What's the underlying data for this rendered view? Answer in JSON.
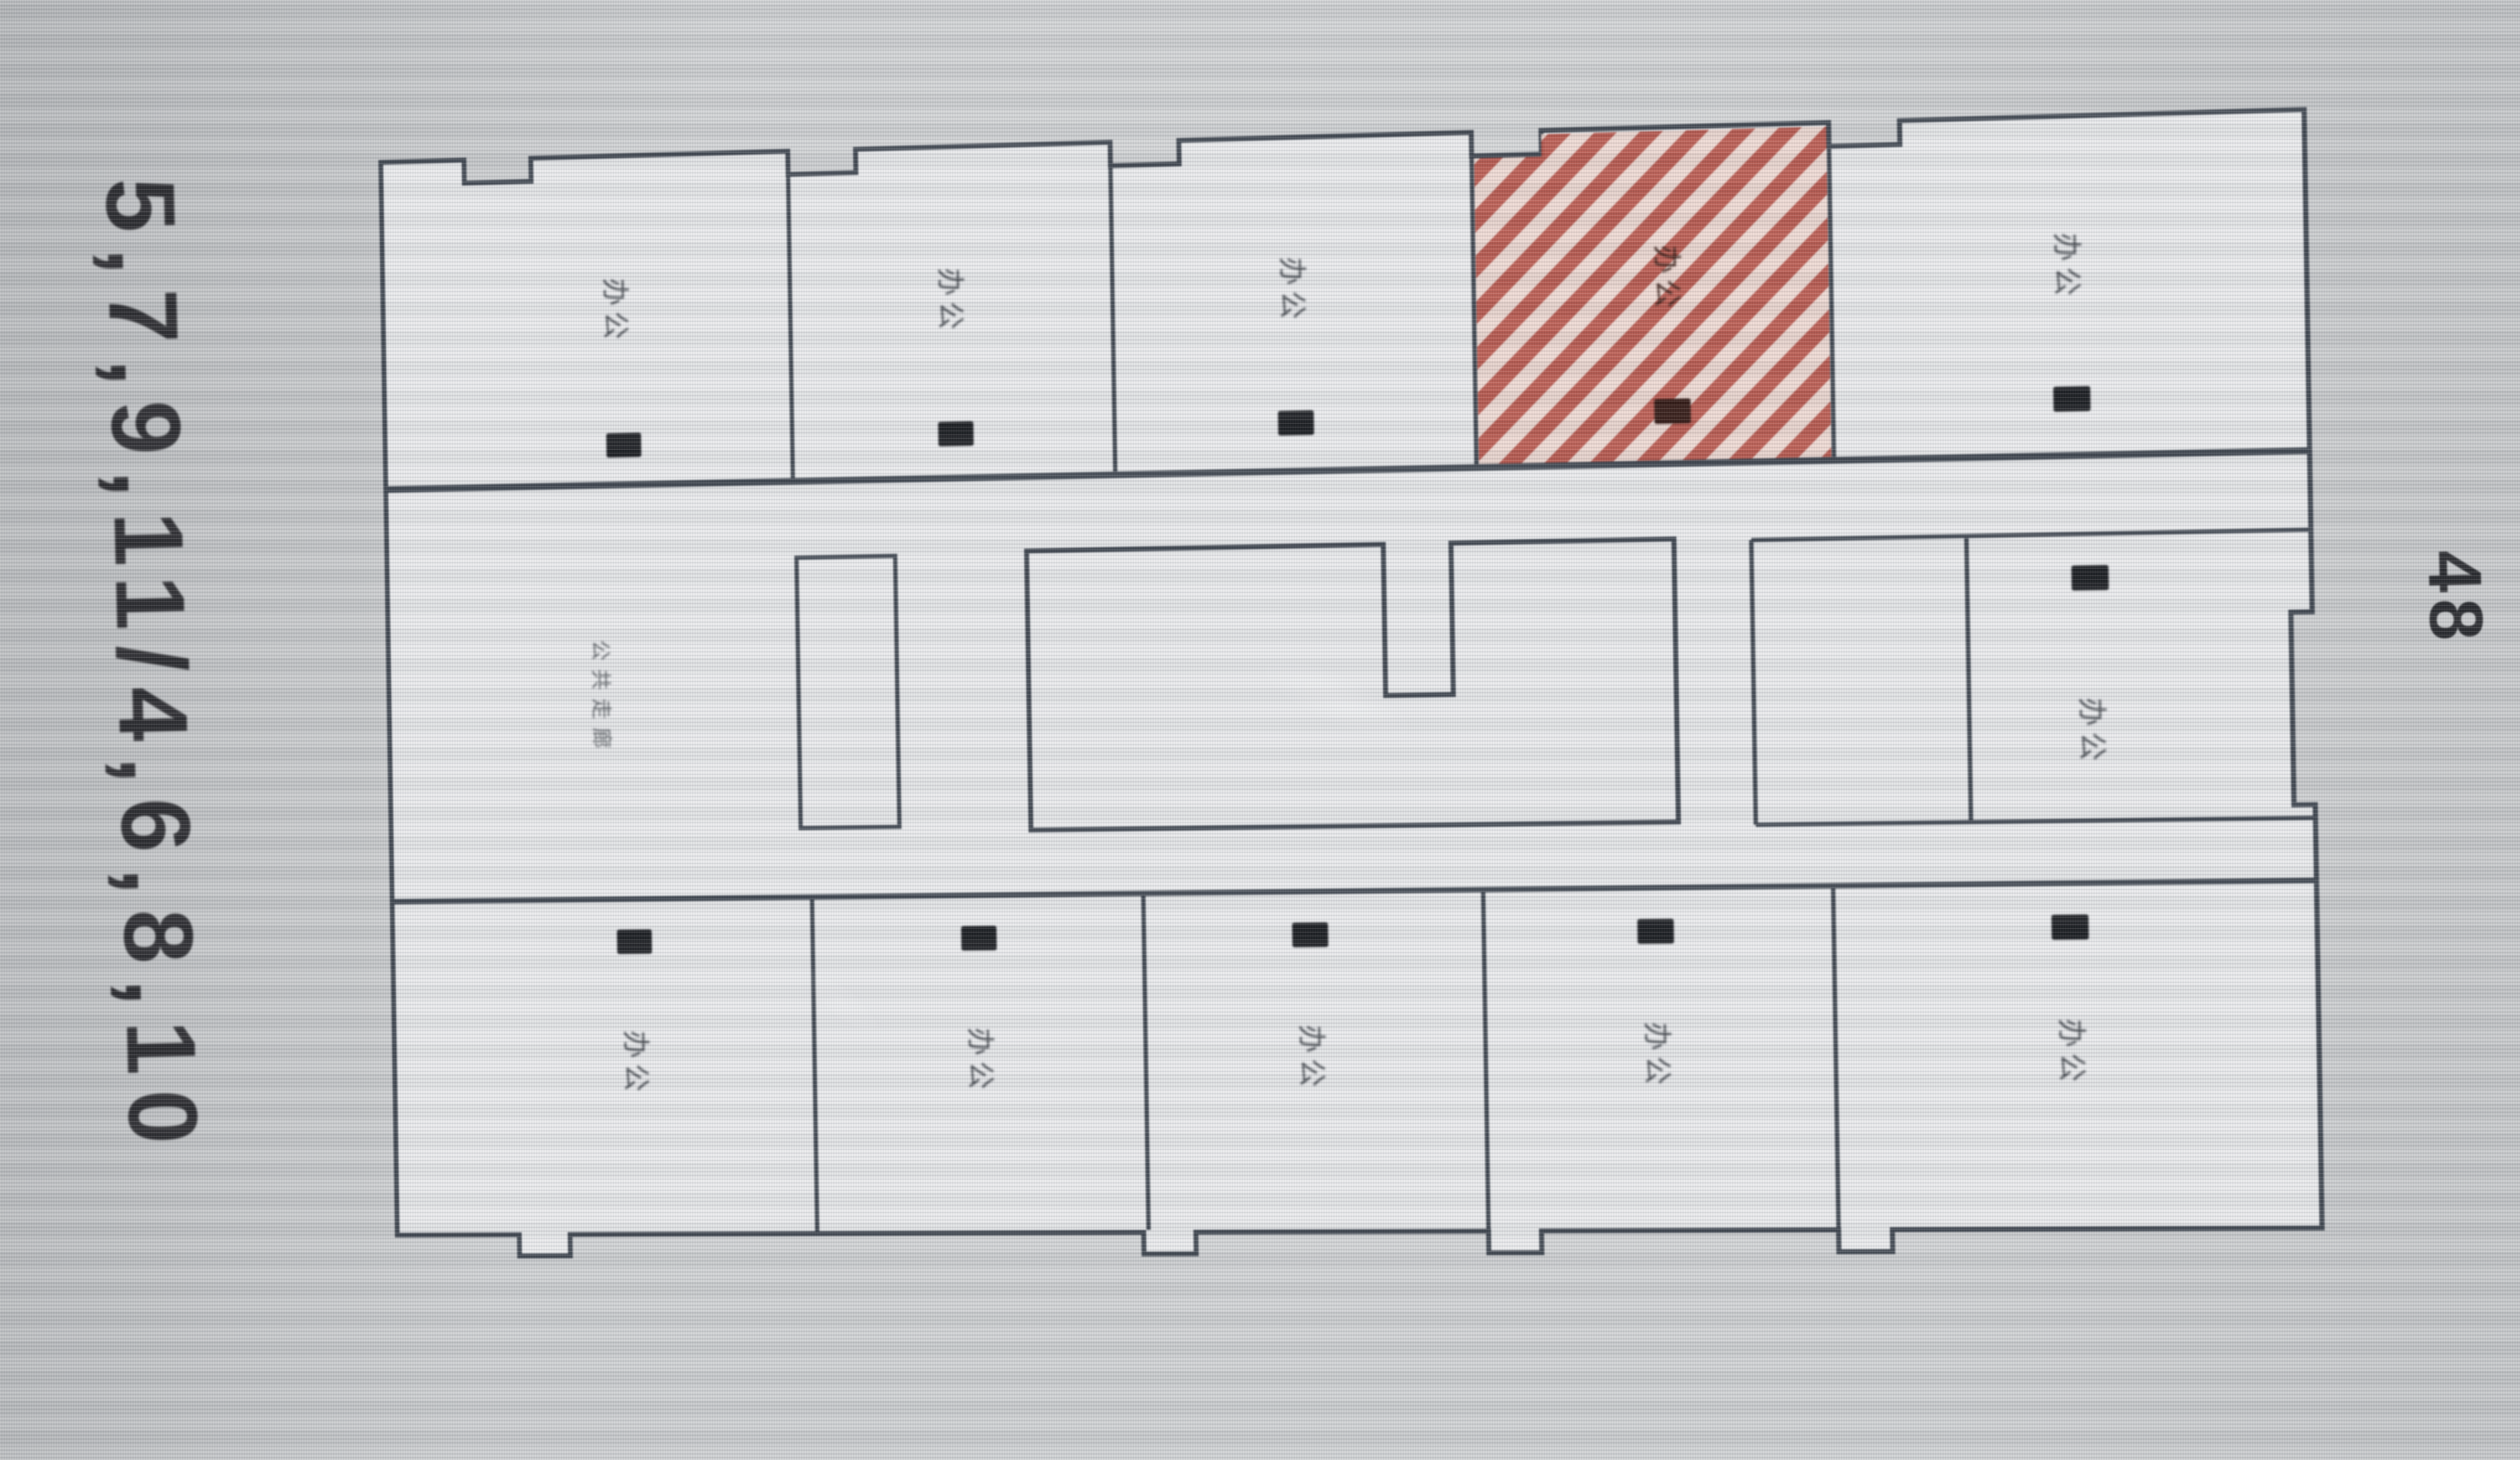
{
  "annotations": {
    "unit_list": "5,7,9,11/4,6,8,10",
    "floor_number": "48"
  },
  "plan": {
    "corridor": {
      "label": "公共走廊"
    },
    "top_rooms": [
      {
        "label": "办公",
        "highlighted": false
      },
      {
        "label": "办公",
        "highlighted": false
      },
      {
        "label": "办公",
        "highlighted": false
      },
      {
        "label": "办公",
        "highlighted": true
      },
      {
        "label": "办公",
        "highlighted": false
      }
    ],
    "middle_rooms": [
      {
        "label": "办公",
        "highlighted": false
      }
    ],
    "bottom_rooms": [
      {
        "label": "办公",
        "highlighted": false
      },
      {
        "label": "办公",
        "highlighted": false
      },
      {
        "label": "办公",
        "highlighted": false
      },
      {
        "label": "办公",
        "highlighted": false
      },
      {
        "label": "办公",
        "highlighted": false
      }
    ],
    "colors": {
      "highlight_hatch": "#b4483c",
      "walls": "#3a414b"
    }
  }
}
